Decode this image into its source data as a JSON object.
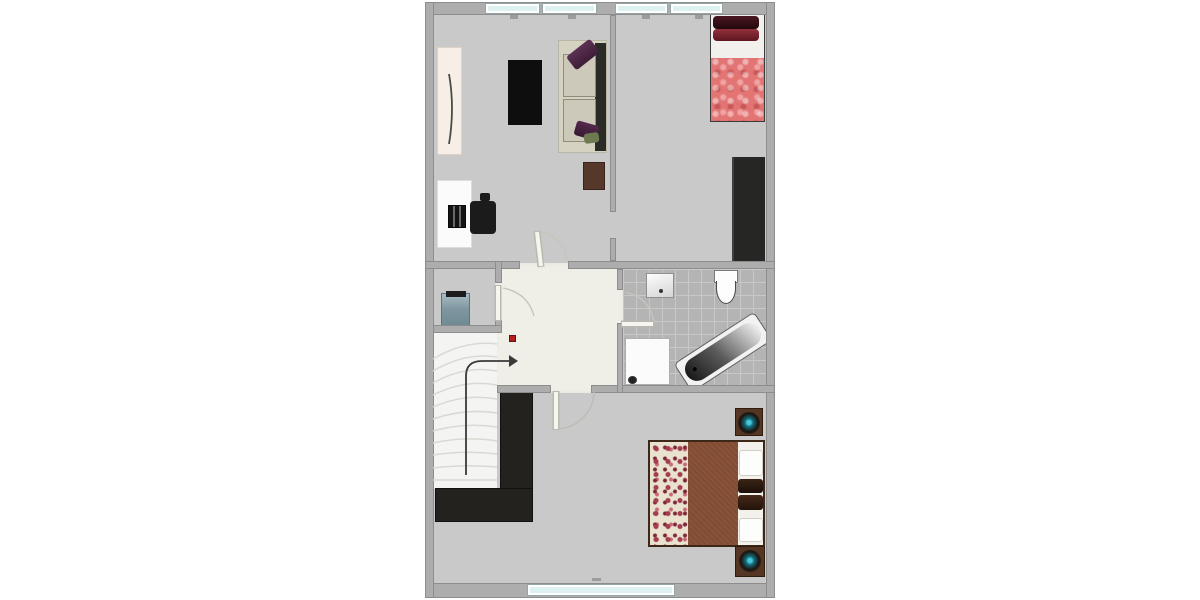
{
  "document": {
    "kind": "floor-plan-render",
    "page_background": "#ffffff",
    "visible_text": "",
    "palette": {
      "wall": "#adadad",
      "wall_outline": "#7d7d7d",
      "floor": "#c9c9c9",
      "hall_floor": "#f0efe7",
      "stairs": "#f4f4f2",
      "bathroom_tile": "#b4b4b4",
      "tile_grout": "#c8c8c8",
      "window_glass": "#ddf1f1",
      "marker_red": "#b22020",
      "arrow": "#3a3a3a"
    },
    "rooms": [
      {
        "id": "living-room",
        "position": "top-left",
        "furniture": [
          "cream-wardrobe",
          "black-rug",
          "sofa",
          "purple-pillows",
          "green-pillow",
          "brown-side-table",
          "desk",
          "monitor",
          "office-chair"
        ]
      },
      {
        "id": "bedroom-top-right",
        "position": "top-right",
        "furniture": [
          "single-bed",
          "dark-red-pillows",
          "pink-blanket",
          "tall-dark-wardrobe"
        ]
      },
      {
        "id": "storage-room",
        "position": "middle-left",
        "furniture": [
          "teal-cabinet"
        ]
      },
      {
        "id": "hallway",
        "position": "middle-center",
        "furniture": [
          "red-marker"
        ]
      },
      {
        "id": "bathroom",
        "position": "middle-right",
        "furniture": [
          "sink",
          "toilet",
          "washing-machine",
          "bathtub"
        ]
      },
      {
        "id": "stairwell",
        "position": "left",
        "furniture": [
          "staircase",
          "direction-arrow"
        ]
      },
      {
        "id": "bedroom-bottom",
        "position": "bottom",
        "furniture": [
          "l-shaped-wardrobe",
          "double-bed",
          "floral-bedspread",
          "brown-blanket",
          "pillows",
          "nightstand-top",
          "nightstand-bottom",
          "decorative-bowls"
        ]
      }
    ],
    "doors": [
      {
        "id": "living-room-door",
        "between": [
          "hallway",
          "living-room"
        ]
      },
      {
        "id": "storage-door",
        "between": [
          "hallway",
          "storage-room"
        ]
      },
      {
        "id": "bathroom-door",
        "between": [
          "hallway",
          "bathroom"
        ]
      },
      {
        "id": "bedroom-bottom-door",
        "between": [
          "hallway",
          "bedroom-bottom"
        ]
      },
      {
        "id": "bedroom-opening",
        "between": [
          "living-room",
          "bedroom-top-right"
        ]
      }
    ],
    "windows": {
      "top_wall": 4,
      "bottom_wall": 1
    },
    "stairs": {
      "direction_arrow": "up-then-right",
      "treads": 11
    },
    "furniture_colors": {
      "sofa_frame": "#d6d2c2",
      "sofa_cushion": "#ccc8ba",
      "sofa_back": "#2a2a26",
      "pillow_purple": "#4e2848",
      "pillow_green": "#6d7a52",
      "rug": "#0e0e0e",
      "cream_wardrobe": "#f7efe7",
      "side_table": "#56382a",
      "desk": "#fbfbfb",
      "office_chair": "#1a1a1a",
      "single_bed_blanket": "#e27474",
      "single_bed_pillow_dark": "#351018",
      "single_bed_pillow_red": "#7e2430",
      "tall_wardrobe": "#262624",
      "teal_cabinet": "#7e97a0",
      "double_bed_blanket": "#8a5238",
      "double_bed_floral": "#e9e2cf",
      "bolster_pillow": "#2c1a10",
      "nightstand": "#553524",
      "bowl_center_teal": "#2aa0b0",
      "l_wardrobe": "#23221f",
      "bathtub_rim": "#f2f2f2"
    }
  }
}
